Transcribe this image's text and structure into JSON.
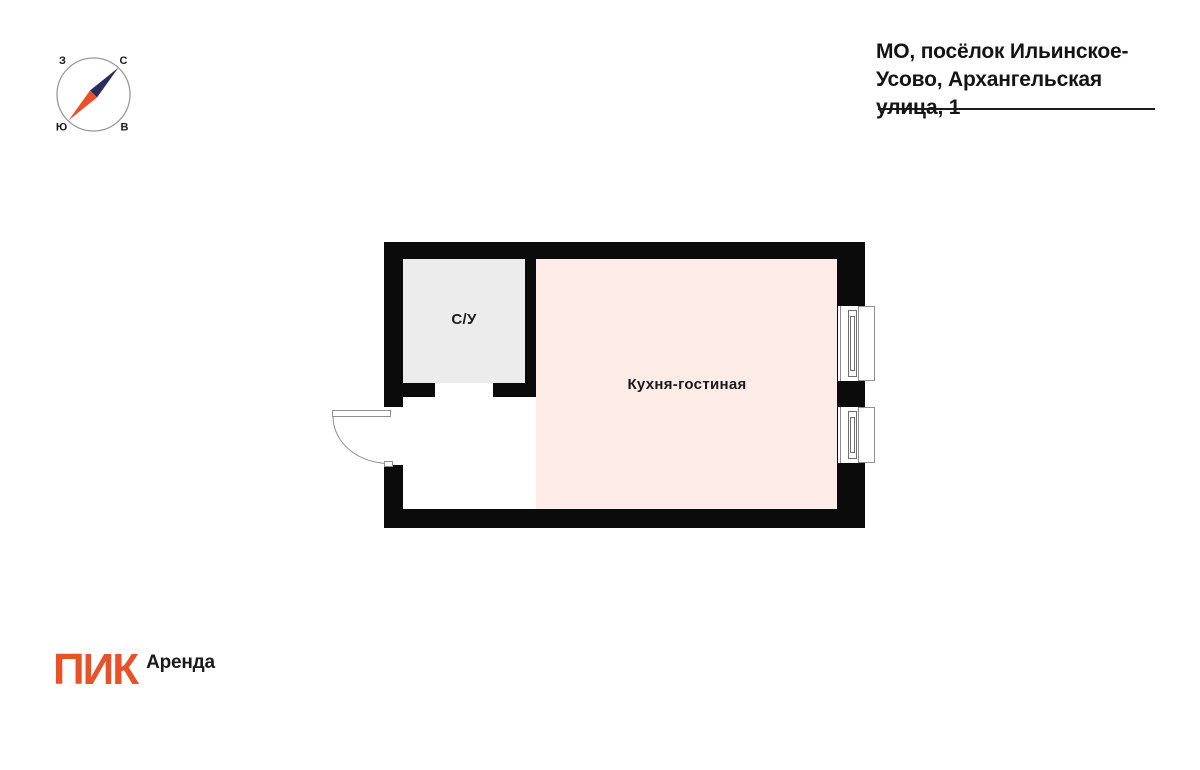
{
  "header": {
    "address_line1": "МО, посёлок Ильинское-",
    "address_line2": "Усово, Архангельская улица, 1"
  },
  "compass": {
    "west_label": "З",
    "north_label": "С",
    "south_label": "Ю",
    "east_label": "В"
  },
  "floorplan": {
    "rooms": {
      "bathroom": {
        "label": "С/У",
        "fill": "#ECECEC"
      },
      "kitchen_living": {
        "label": "Кухня-гостиная",
        "fill": "#FCEBE7"
      }
    }
  },
  "logo": {
    "brand": "ПИК",
    "product": "Аренда",
    "brand_color": "#E95228"
  },
  "colors": {
    "wall": "#0A0A0A",
    "plan_line_gray": "#8F8F8F",
    "needle_navy": "#2B2C5E",
    "needle_orange": "#E95228",
    "text": "#141414"
  }
}
